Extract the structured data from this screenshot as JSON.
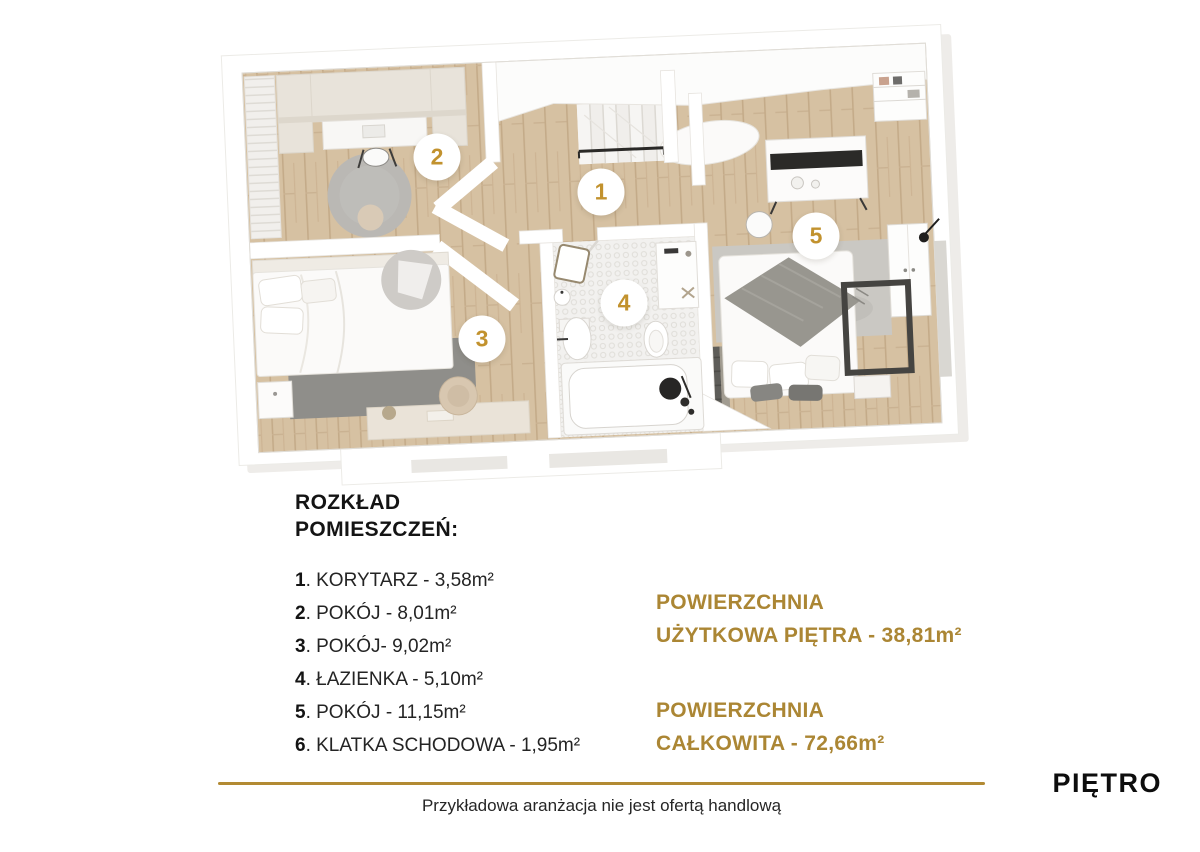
{
  "plan": {
    "badges": [
      {
        "n": "1"
      },
      {
        "n": "2"
      },
      {
        "n": "3"
      },
      {
        "n": "4"
      },
      {
        "n": "5"
      }
    ],
    "badge_number_color": "#c2922e"
  },
  "legend": {
    "title_line1": "ROZKŁAD",
    "title_line2": "POMIESZCZEŃ:",
    "rooms": [
      {
        "no": "1",
        "desc": ". KORYTARZ - 3,58m²"
      },
      {
        "no": "2",
        "desc": ". POKÓJ - 8,01m²"
      },
      {
        "no": "3",
        "desc": ". POKÓJ- 9,02m²"
      },
      {
        "no": "4",
        "desc": ". ŁAZIENKA - 5,10m²"
      },
      {
        "no": "5",
        "desc": ". POKÓJ - 11,15m²"
      },
      {
        "no": "6",
        "desc": ". KLATKA SCHODOWA - 1,95m²"
      }
    ]
  },
  "areas": {
    "accent_color": "#ab8634",
    "usable_line1": "POWIERZCHNIA",
    "usable_line2": "UŻYTKOWA PIĘTRA - 38,81m²",
    "total_line1": "POWIERZCHNIA",
    "total_line2": "CAŁKOWITA - 72,66m²"
  },
  "footer": {
    "rule_color": "#b28a33",
    "disclaimer": "Przykładowa aranżacja nie jest ofertą handlową",
    "floor_label": "PIĘTRO"
  }
}
